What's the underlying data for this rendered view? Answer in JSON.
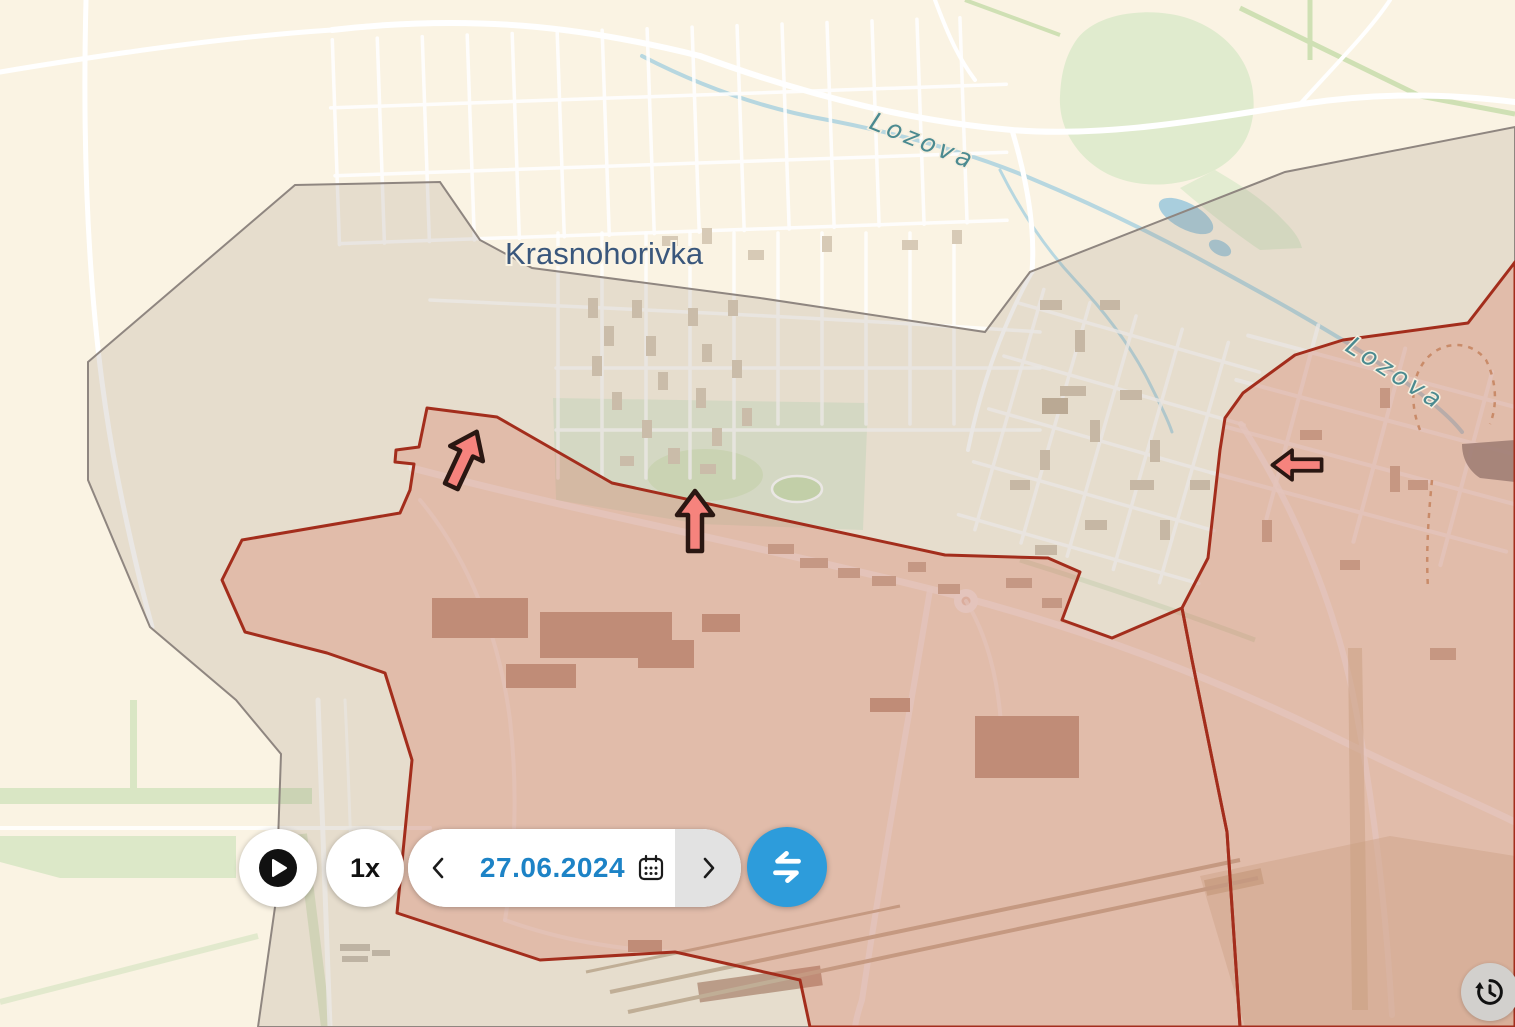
{
  "map": {
    "city_label": "Krasnohorivka",
    "river_label_1": "Lozova",
    "river_label_2": "Lozova",
    "zones": {
      "contested_grey": {
        "fill": "#978878",
        "stroke": "#8f8680",
        "description": "grey contested zone"
      },
      "occupied_red": {
        "fill": "#d55c44",
        "stroke": "#a32d1c",
        "description": "red occupied zone"
      }
    },
    "arrows": [
      {
        "direction": "up-right",
        "transform": "translate(464,459) rotate(25)"
      },
      {
        "direction": "up",
        "transform": "translate(695,521)"
      },
      {
        "direction": "left",
        "transform": "translate(1297,465) rotate(-90) scale(0.82)"
      }
    ],
    "arrow_color": "#f6837d"
  },
  "timeline": {
    "speed_label": "1x",
    "date_value": "27.06.2024",
    "accent_color": "#2d9cdb",
    "date_color": "#1d83c6"
  }
}
